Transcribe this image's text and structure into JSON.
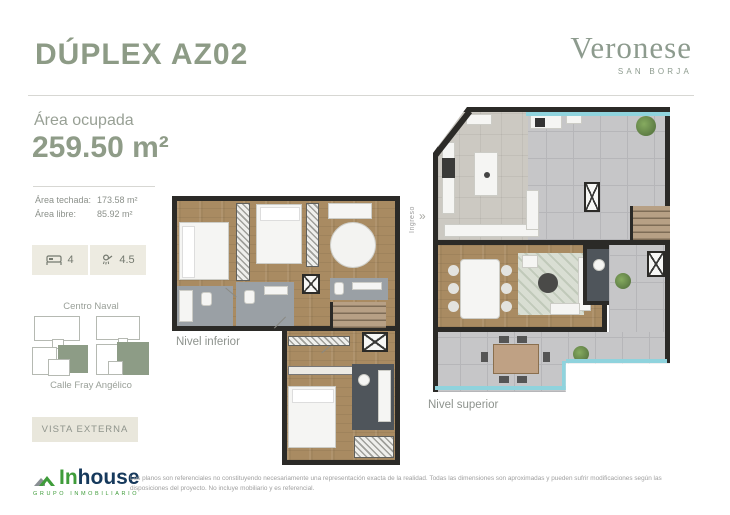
{
  "header": {
    "title": "DÚPLEX AZ02"
  },
  "brand": {
    "name": "Veronese",
    "location": "SAN BORJA"
  },
  "sidebar": {
    "area_label": "Área ocupada",
    "area_value": "259.50 m²",
    "rows": [
      {
        "label": "Área techada:",
        "value": "173.58 m²"
      },
      {
        "label": "Área libre:",
        "value": "85.92 m²"
      }
    ],
    "beds_count": "4",
    "baths_count": "4.5",
    "map_top_label": "Centro Naval",
    "map_bottom_label": "Calle Fray Angélico",
    "vista_button_label": "VISTA EXTERNA"
  },
  "plans": {
    "inferior_label": "Nivel inferior",
    "superior_label": "Nivel superior",
    "ingreso_label": "Ingreso",
    "ingreso_chevrons": "»"
  },
  "footer": {
    "logo_text_1": "In",
    "logo_text_2": "house",
    "logo_subtitle": "GRUPO INMOBILIARIO",
    "disclaimer": "Los planos son referenciales no constituyendo necesariamente una representación exacta de la realidad. Todas las dimensiones son aproximadas y pueden sufrir modificaciones según las disposiciones del proyecto. No incluye mobiliario y es referencial."
  },
  "icons": {
    "beds": "bed-icon",
    "baths": "shower-icon"
  },
  "colors": {
    "accent_green": "#8d9b86",
    "badge_bg": "#edebe1",
    "logo_green": "#3f9c3a",
    "logo_navy": "#16395c",
    "wood_floor": "#a98b62",
    "terrace_gray": "#c6c6c8",
    "glass_blue": "#8fd3dd"
  }
}
